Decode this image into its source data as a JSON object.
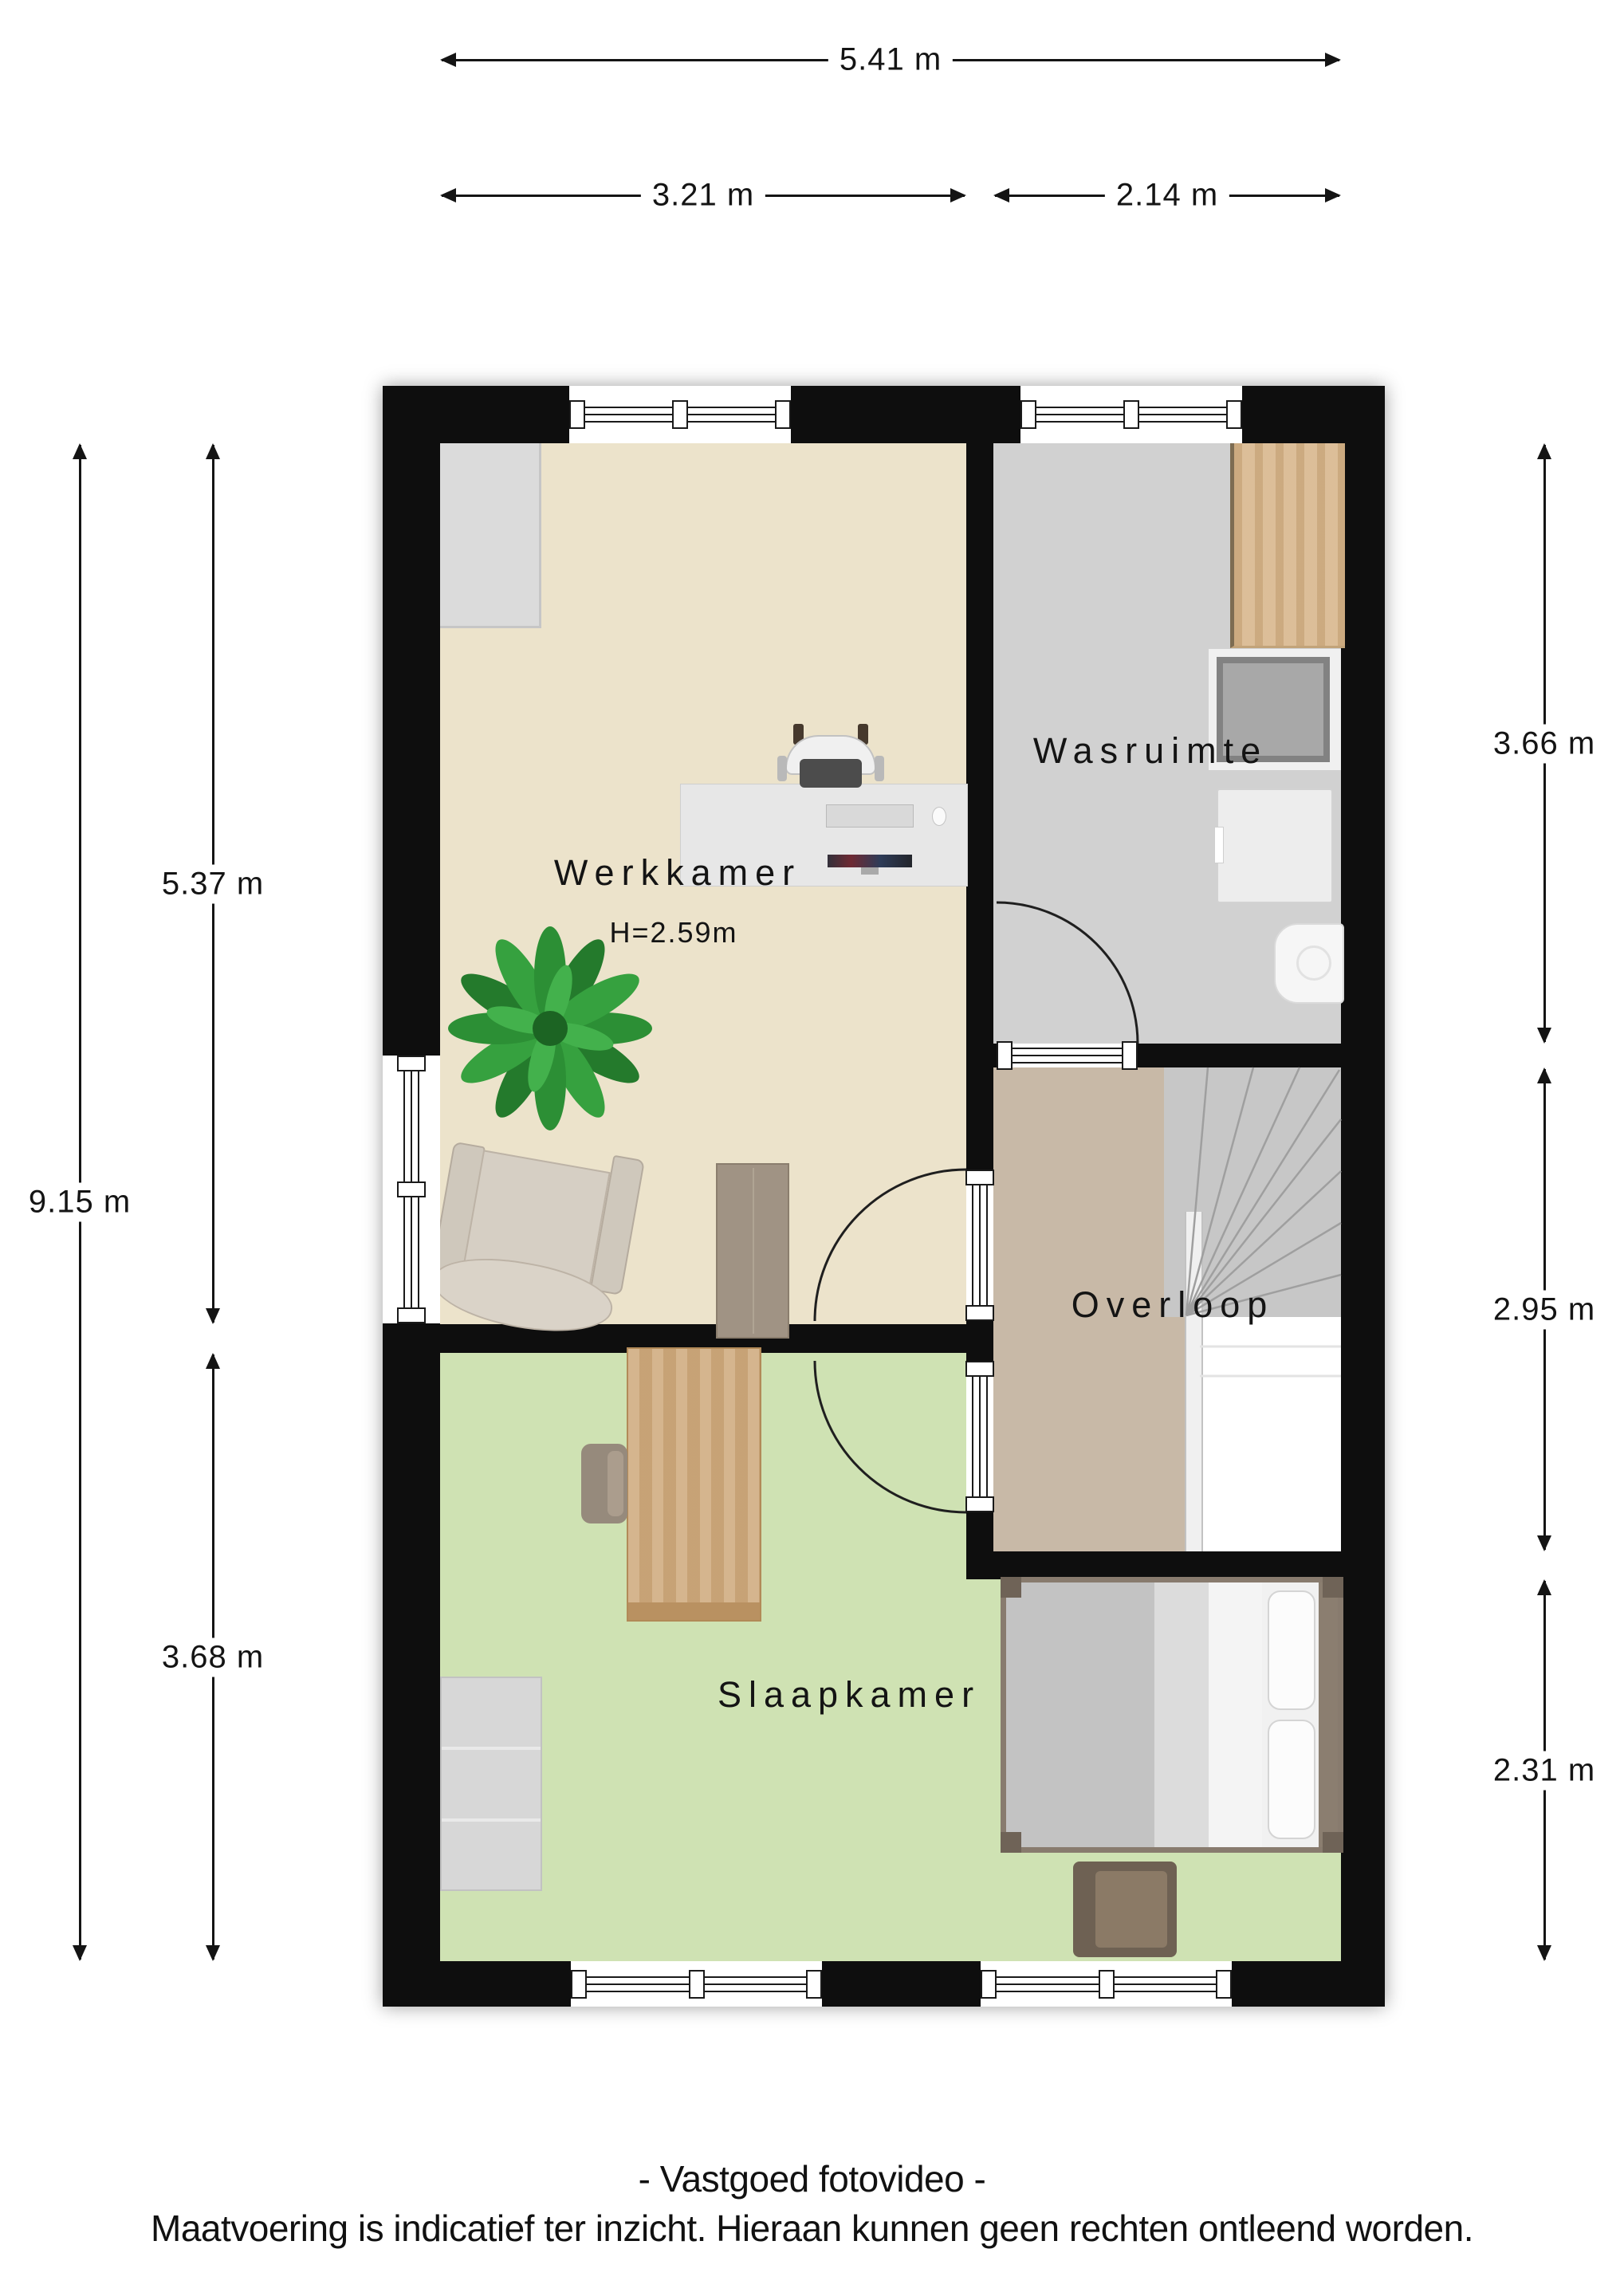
{
  "page": {
    "background": "#ffffff",
    "wall_color": "#0e0e0e"
  },
  "floor_plan": {
    "rooms": [
      {
        "id": "werkkamer",
        "label": "Werkkamer",
        "ceiling_height": "H=2.59m",
        "floor_color": "#ece3cb",
        "furniture": [
          "closet",
          "desk",
          "office-chair",
          "keyboard",
          "monitor",
          "mouse",
          "plant",
          "armchair",
          "wood-plank"
        ]
      },
      {
        "id": "wasruimte",
        "label": "Wasruimte",
        "floor_color": "#d1d1d1",
        "furniture": [
          "wood-counter",
          "washing-machine",
          "dryer",
          "sink"
        ]
      },
      {
        "id": "overloop",
        "label": "Overloop",
        "floor_color": "#c8b9a7",
        "furniture": [
          "staircase"
        ]
      },
      {
        "id": "slaapkamer",
        "label": "Slaapkamer",
        "floor_color": "#cfe2b3",
        "furniture": [
          "desk",
          "desk-chair",
          "dresser",
          "double-bed",
          "pillows",
          "ottoman"
        ]
      }
    ]
  },
  "dimensions": {
    "top": [
      {
        "label": "5.41 m"
      },
      {
        "label": "3.21 m"
      },
      {
        "label": "2.14 m"
      }
    ],
    "left": [
      {
        "label": "9.15 m"
      },
      {
        "label": "5.37 m"
      },
      {
        "label": "3.68 m"
      }
    ],
    "right": [
      {
        "label": "3.66 m"
      },
      {
        "label": "2.95 m"
      },
      {
        "label": "2.31 m"
      }
    ]
  },
  "footer": {
    "line1": "- Vastgoed fotovideo -",
    "line2": "Maatvoering is indicatief ter inzicht. Hieraan kunnen geen rechten ontleend worden."
  }
}
